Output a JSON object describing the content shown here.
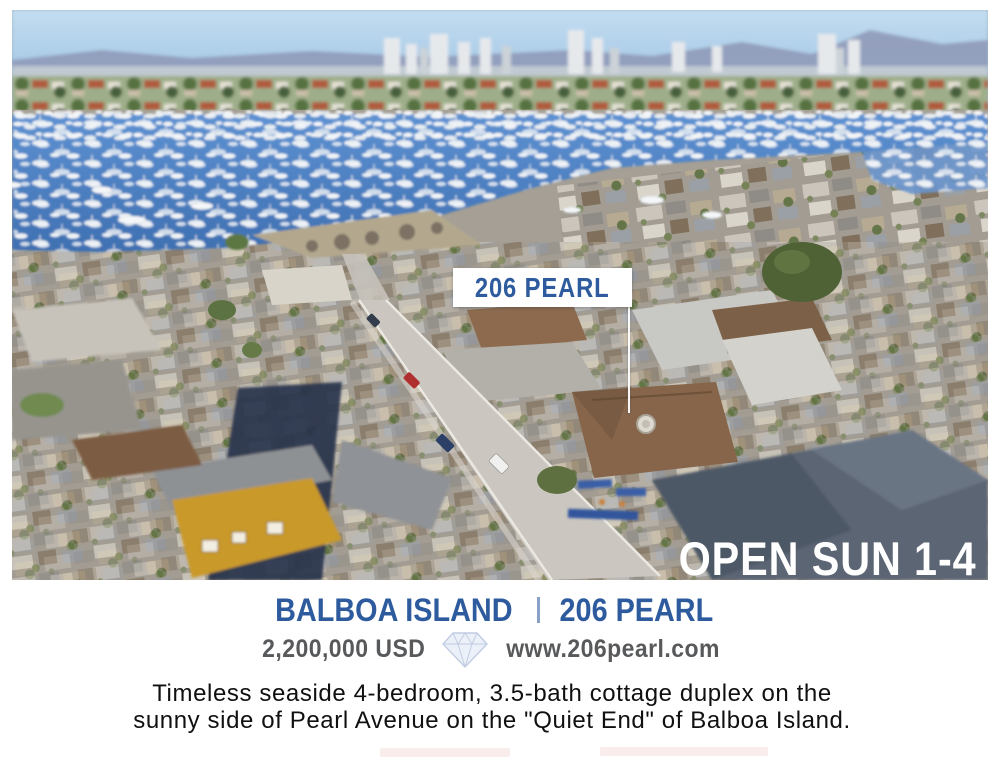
{
  "photo": {
    "marker_label": "206 PEARL",
    "open_house": "OPEN SUN 1-4"
  },
  "listing": {
    "location": "BALBOA ISLAND",
    "address": "206 PEARL",
    "price": "2,200,000 USD",
    "website": "www.206pearl.com",
    "description_line1": "Timeless seaside 4-bedroom, 3.5-bath cottage duplex on the",
    "description_line2": "sunny side of Pearl Avenue on the \"Quiet End\" of Balboa Island."
  },
  "colors": {
    "title_blue": "#2d5b9e",
    "price_gray": "#58595b",
    "marker_text_blue": "#2d5b9e",
    "open_house_white": "#ffffff"
  },
  "icons": {
    "logo": "gem-logo-icon"
  }
}
